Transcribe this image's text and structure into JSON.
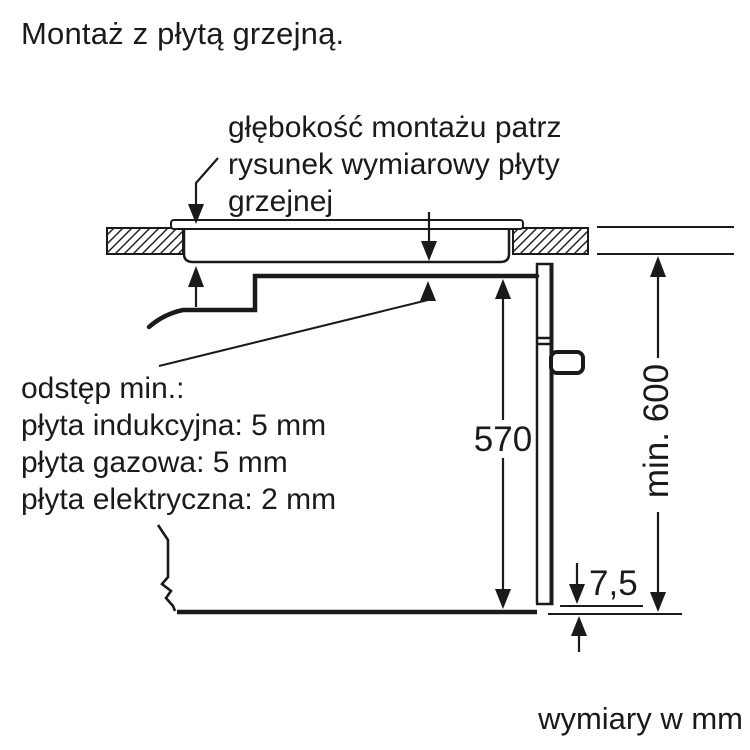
{
  "title": "Montaż z płytą grzejną.",
  "annotation": {
    "line1": "głębokość montażu patrz",
    "line2": "rysunek wymiarowy płyty",
    "line3": "grzejnej"
  },
  "clearance_note": {
    "heading": "odstęp min.:",
    "induction": "płyta indukcyjna: 5 mm",
    "gas": "płyta gazowa: 5 mm",
    "electric": "płyta elektryczna: 2 mm"
  },
  "dimensions": {
    "oven_height_mm": "570",
    "niche_height_mm": "min. 600",
    "front_overhang_mm": "7,5"
  },
  "footer": "wymiary w mm",
  "colors": {
    "line": "#1a1a1a",
    "background": "#ffffff"
  }
}
